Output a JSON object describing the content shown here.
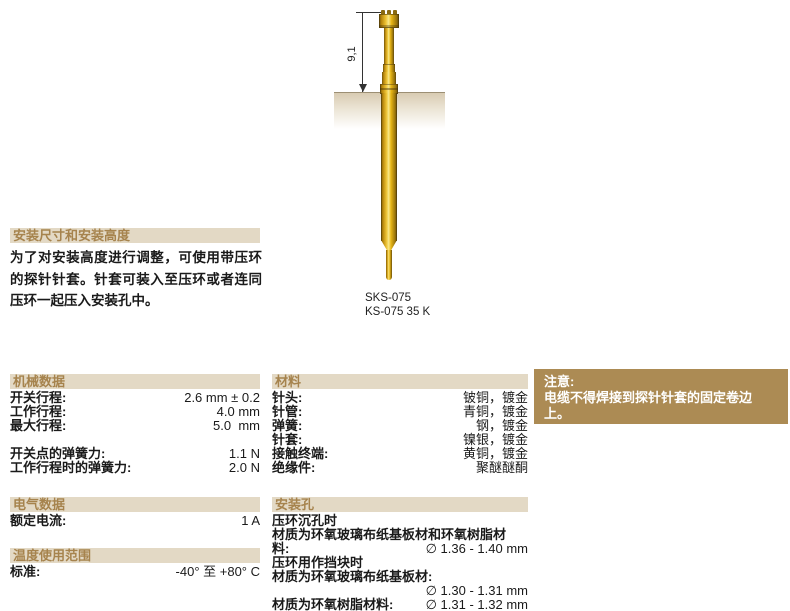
{
  "page": {
    "diagram": {
      "dimension_label": "9,1",
      "model_line1": "SKS-075",
      "model_line2": "KS-075 35 K"
    },
    "install": {
      "title": "安装尺寸和安装高度",
      "body": "为了对安装高度进行调整，可使用带压环的探针针套。针套可装入至压环或者连同压环一起压入安装孔中。"
    },
    "mechanical": {
      "title": "机械数据",
      "rows": [
        {
          "label": "开关行程:",
          "value": "2.6 mm ± 0.2"
        },
        {
          "label": "工作行程:",
          "value": "4.0 mm"
        },
        {
          "label": "最大行程:",
          "value": "5.0  mm"
        },
        {
          "label": "",
          "value": ""
        },
        {
          "label": "开关点的弹簧力:",
          "value": "1.1 N"
        },
        {
          "label": "工作行程时的弹簧力:",
          "value": "2.0 N"
        }
      ]
    },
    "materials": {
      "title": "材料",
      "rows": [
        {
          "label": "针头:",
          "value": "铍铜，镀金"
        },
        {
          "label": "针管:",
          "value": "青铜，镀金"
        },
        {
          "label": "弹簧:",
          "value": "钢，镀金"
        },
        {
          "label": "针套:",
          "value": "镍银，镀金"
        },
        {
          "label": "接触终端:",
          "value": "黄铜，镀金"
        },
        {
          "label": "绝缘件:",
          "value": "聚醚醚酮"
        }
      ]
    },
    "electrical": {
      "title": "电气数据",
      "rows": [
        {
          "label": "额定电流:",
          "value": "1 A"
        }
      ]
    },
    "temperature": {
      "title": "温度使用范围",
      "rows": [
        {
          "label": "标准:",
          "value": "-40° 至 +80° C"
        }
      ]
    },
    "mounting": {
      "title": "安装孔",
      "rows": [
        {
          "label": "压环沉孔时",
          "value": ""
        },
        {
          "label": "材质为环氧玻璃布纸基板材和环氧树脂材",
          "value": ""
        },
        {
          "label": "料:",
          "value": "∅ 1.36 - 1.40 mm"
        },
        {
          "label": "压环用作挡块时",
          "value": ""
        },
        {
          "label": "材质为环氧玻璃布纸基板材:",
          "value": ""
        },
        {
          "label": "",
          "value": "∅ 1.30 - 1.31 mm"
        },
        {
          "label": "材质为环氧树脂材料:",
          "value": "∅ 1.31 - 1.32 mm"
        }
      ]
    },
    "note": {
      "title": "注意:",
      "body": "电缆不得焊接到探针针套的固定卷边上。"
    },
    "colors": {
      "header_bg": "#e3d9c5",
      "header_text": "#a6834d",
      "note_bg": "#ac8b54",
      "note_text": "#ffffff",
      "probe_gold": "#e8b615",
      "board_tan": "#d8cbb2"
    }
  }
}
